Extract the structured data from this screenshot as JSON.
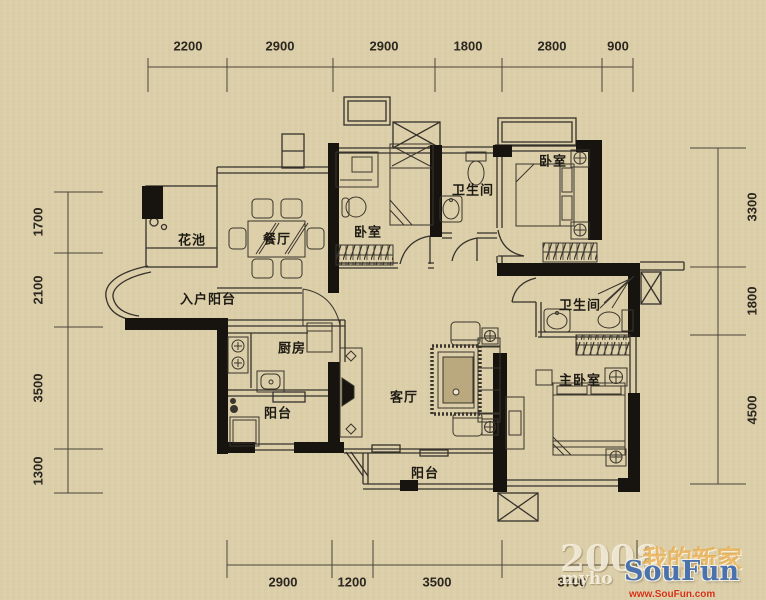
{
  "title": "apartment-floor-plan",
  "colors": {
    "background": "#dccfa9",
    "line": "#36312b",
    "wall": "#17130e",
    "logo_blue": "#4a72ad",
    "url_red": "#d43010",
    "slogan_orange": "#e6a43c"
  },
  "rooms": {
    "flower_pool": "花池",
    "dining": "餐厅",
    "bedroom_top": "卧室",
    "bath_top": "卫生间",
    "bedroom_right": "卧室",
    "entry_balcony": "入户阳台",
    "kitchen": "厨房",
    "bath_mid": "卫生间",
    "living": "客厅",
    "master_bedroom": "主卧室",
    "balcony_left": "阳台",
    "balcony_bottom": "阳台"
  },
  "dimensions": {
    "top": [
      "2200",
      "2900",
      "2900",
      "1800",
      "2800",
      "900"
    ],
    "bottom": [
      "2900",
      "1200",
      "3500",
      "3700"
    ],
    "left": [
      "1700",
      "2100",
      "3500",
      "1300"
    ],
    "right": [
      "3300",
      "1800",
      "4500"
    ]
  },
  "watermark": {
    "year": "2008",
    "slogan_cn": "我的新家",
    "site_prefix": "myho",
    "logo": "SouFun",
    "url": "www.SouFun.com"
  }
}
